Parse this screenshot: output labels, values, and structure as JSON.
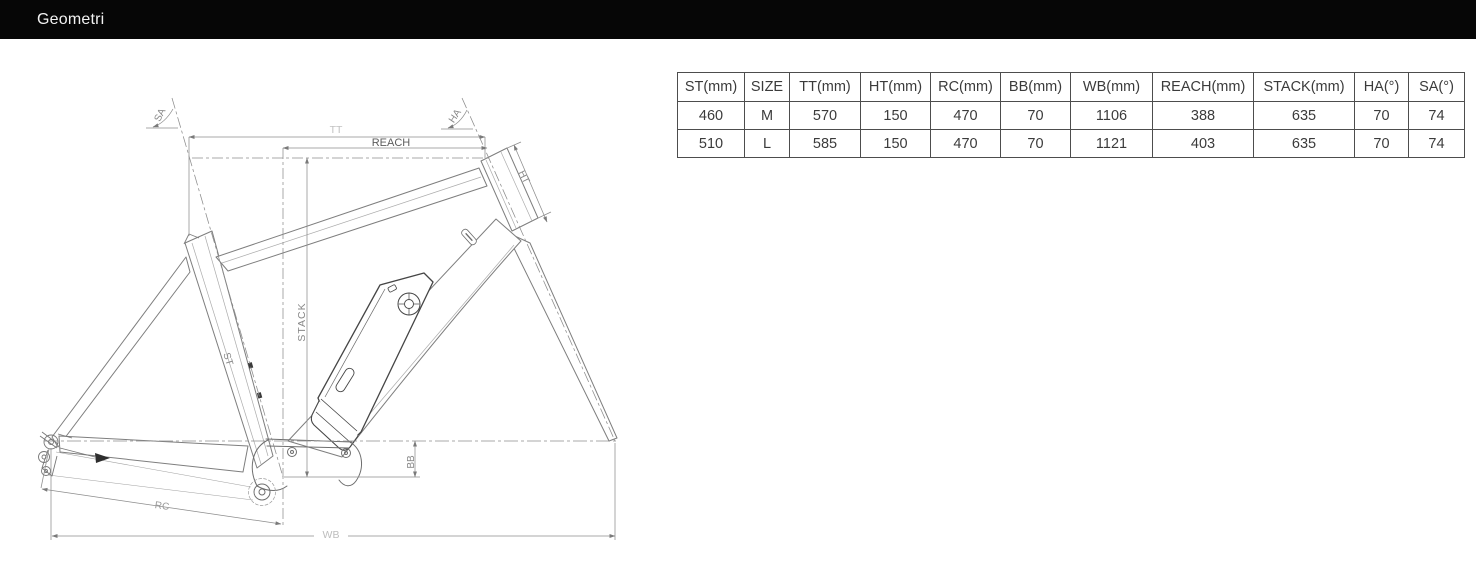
{
  "header": {
    "title": "Geometri",
    "bg_color": "#060606",
    "text_color": "#f2f2f2"
  },
  "geometry_table": {
    "columns": [
      "ST(mm)",
      "SIZE",
      "TT(mm)",
      "HT(mm)",
      "RC(mm)",
      "BB(mm)",
      "WB(mm)",
      "REACH(mm)",
      "STACK(mm)",
      "HA(°)",
      "SA(°)"
    ],
    "rows": [
      [
        "460",
        "M",
        "570",
        "150",
        "470",
        "70",
        "1106",
        "388",
        "635",
        "70",
        "74"
      ],
      [
        "510",
        "L",
        "585",
        "150",
        "470",
        "70",
        "1121",
        "403",
        "635",
        "70",
        "74"
      ]
    ]
  },
  "drawing": {
    "labels": {
      "sa": "SA",
      "tt": "TT",
      "reach": "REACH",
      "ha": "HA",
      "ht": "HT",
      "st": "ST",
      "stack": "STACK",
      "bb": "BB",
      "rc": "RC",
      "wb": "WB"
    }
  }
}
